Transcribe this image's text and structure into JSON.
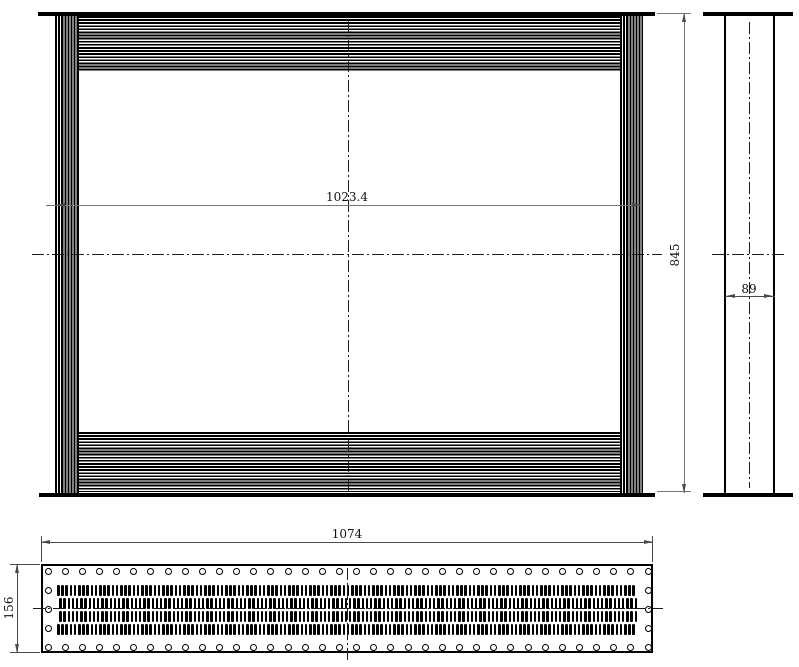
{
  "dimensions": {
    "front_width": "1023.4",
    "overall_height": "845",
    "side_depth": "89",
    "sheet_length": "1074",
    "sheet_width": "156"
  },
  "colors": {
    "object_line": "#000000",
    "dimension_line_light": "#777777",
    "dimension_line_dark": "#4a4a4a",
    "dimension_text": "#111111",
    "background": "#ffffff"
  },
  "geometry": {
    "holes": {
      "diameter": 7,
      "row_x_start": 48,
      "row_x_end": 648,
      "row_count": 36,
      "top_row_y": 571,
      "bottom_row_y": 647,
      "side_column_left_x": 48,
      "side_column_right_x": 648,
      "side_column_ys": [
        590,
        609,
        628
      ]
    },
    "slots": {
      "x_start": 57,
      "pitch": 4.2,
      "count_per_row": 138,
      "width": 2.6,
      "height": 11,
      "rows": [
        {
          "top": 585,
          "offset": 0
        },
        {
          "top": 598,
          "offset": 2.1
        },
        {
          "top": 611,
          "offset": 2.1
        },
        {
          "top": 624,
          "offset": 0
        }
      ]
    }
  }
}
